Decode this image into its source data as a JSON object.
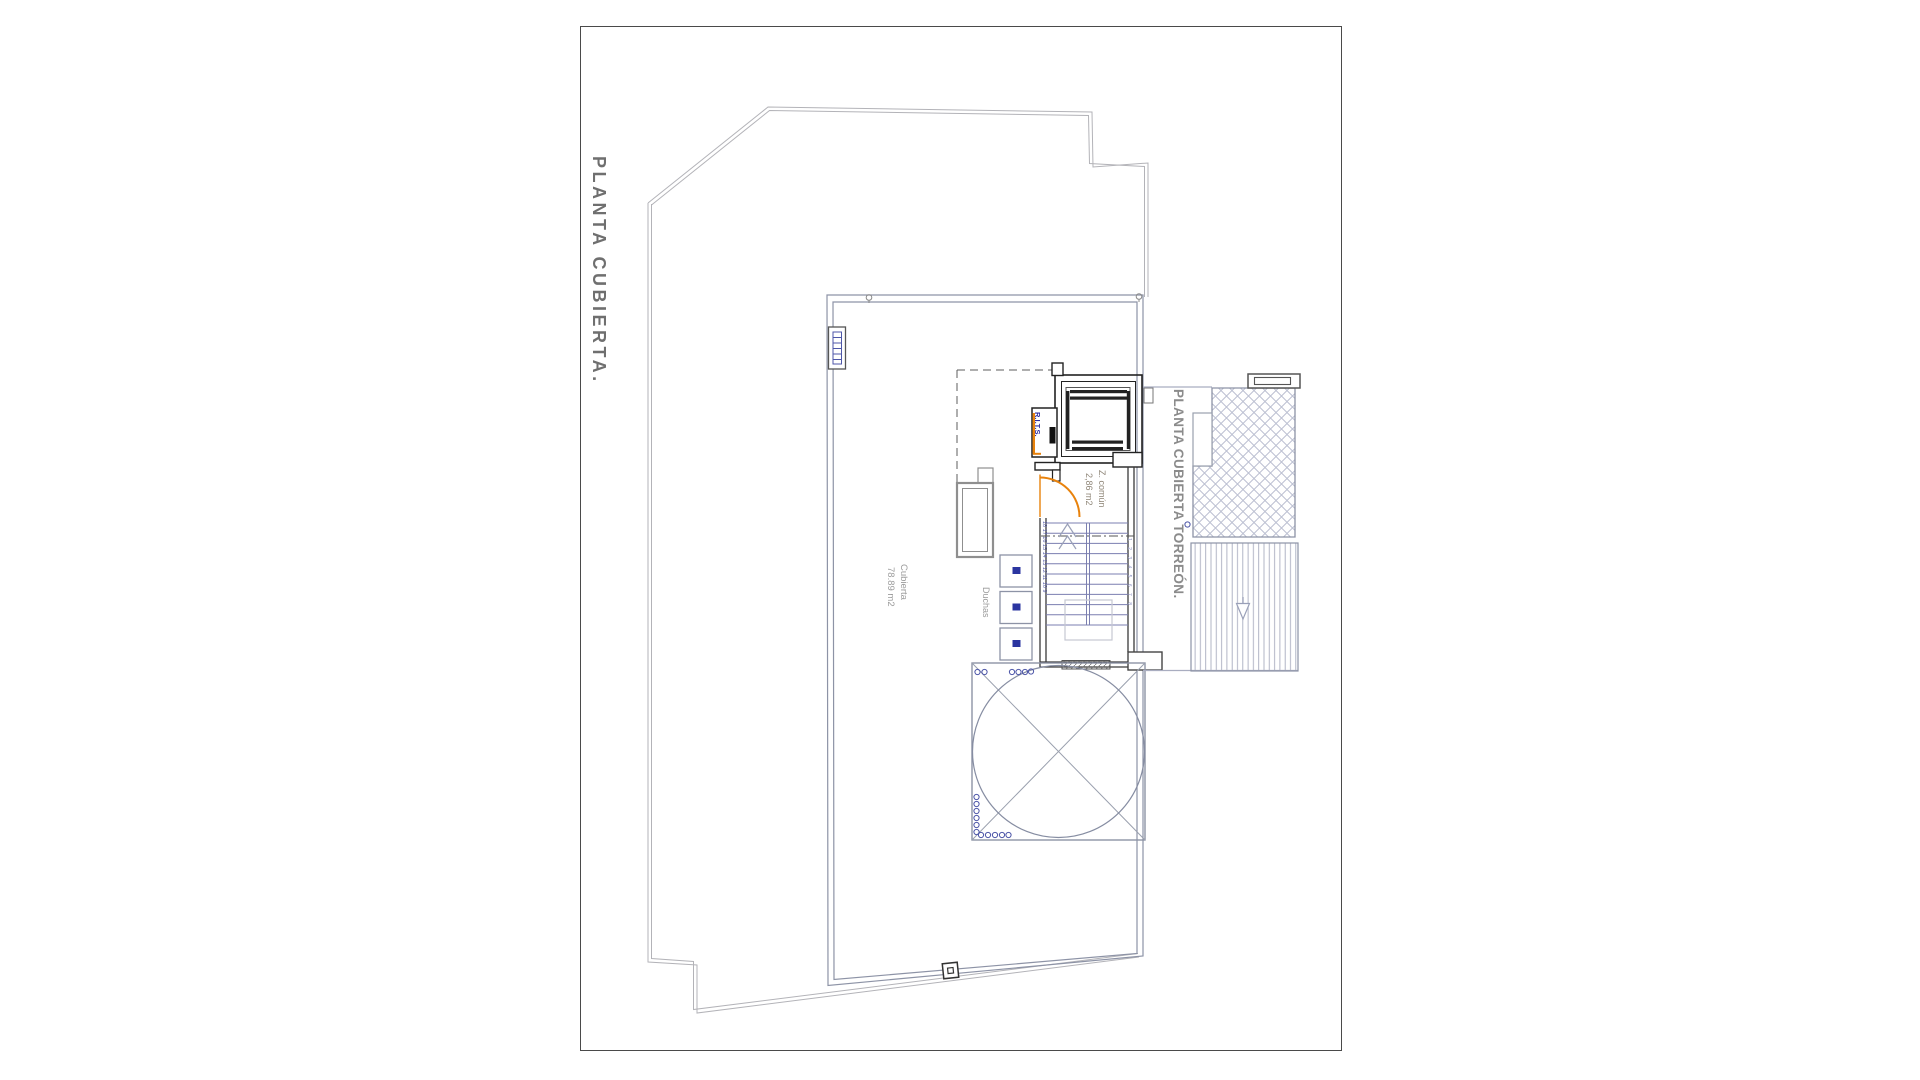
{
  "sheet": {
    "title": "PLANTA CUBIERTA."
  },
  "plan": {
    "roof_area_label": {
      "line1": "Cubierta",
      "line2": "78.89 m2"
    },
    "showers_label": "Duchas",
    "common_zone_label": {
      "line1": "Z. común",
      "line2": "2,86 m2"
    },
    "telecom_room_label": "R.I.T.S.",
    "torreon_title": "PLANTA CUBIERTA TORREÓN."
  },
  "stairs": {
    "numbers_left": "18 17 16 15 14 13 12 11 10 9",
    "numbers_right": "1 2 3 4 5 6 7 8"
  },
  "colors": {
    "accent_orange": "#E8820C",
    "core_blue": "#2E2EA0",
    "stair_blue": "#7B7FB0",
    "drain_blue": "#2B35A0",
    "wall_gray": "#8D93A6",
    "parcel_gray": "#B3B3B8",
    "black_wall": "#222222",
    "text_gray": "#9A9A9A",
    "title_gray": "#6F6F6F"
  }
}
